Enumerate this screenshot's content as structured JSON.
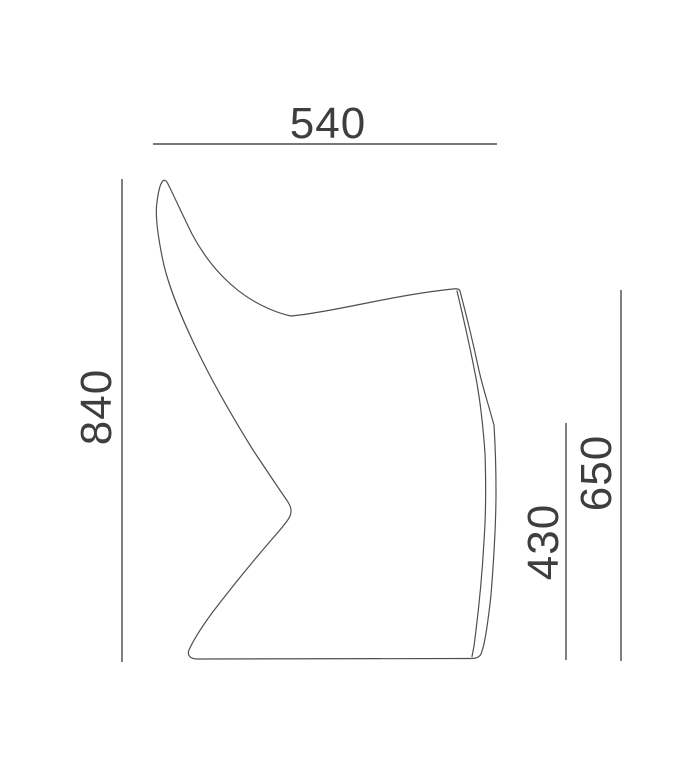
{
  "drawing_title": "chair-side-view-dimension-diagram",
  "dimensions": {
    "width": "540",
    "height": "840",
    "back_height": "650",
    "seat_height": "430"
  },
  "colors": {
    "line": "#4f4f4f",
    "text": "#3e3e3e",
    "background": "#ffffff"
  },
  "drawing": {
    "outline_path": "M 162,182 C 164,179 166,180 168,184 C 175,198 183,216 192,234 C 209,266 233,291 261,305 C 271,310 281,314 291,316 C 312,314 342,308 372,302 C 402,296 432,291 453,289 C 456,288.6 459,288.4 460,291 C 465,310 472,338 478,366 C 482,385 487,400 490,411 L 494,425 C 495,441 496,466 496,492 C 496,526 494,557 491,595 C 488,622 485,643 482,651 C 481,656 478,658.5 471,658.5 L 197,659 C 190,659 187,655 189,650 C 193,641 201,628 212,613 C 231,588 254,560 273,538 C 281,529 288,521 290,516 C 292,511 291,507 288,502 C 279,489 267,471 253,450 C 235,421 215,387 198,352 C 183,321 169,289 163,261 C 158,237 155,214 157,202 C 158,194 160,185 162,182 Z",
    "inner_edge_path": "M 457,291 C 462,312 469,342 475,373 C 480,398 483,425 485,453 C 486,483 486,513 484,541 C 482,578 478,616 474,646 L 472,656.5"
  }
}
